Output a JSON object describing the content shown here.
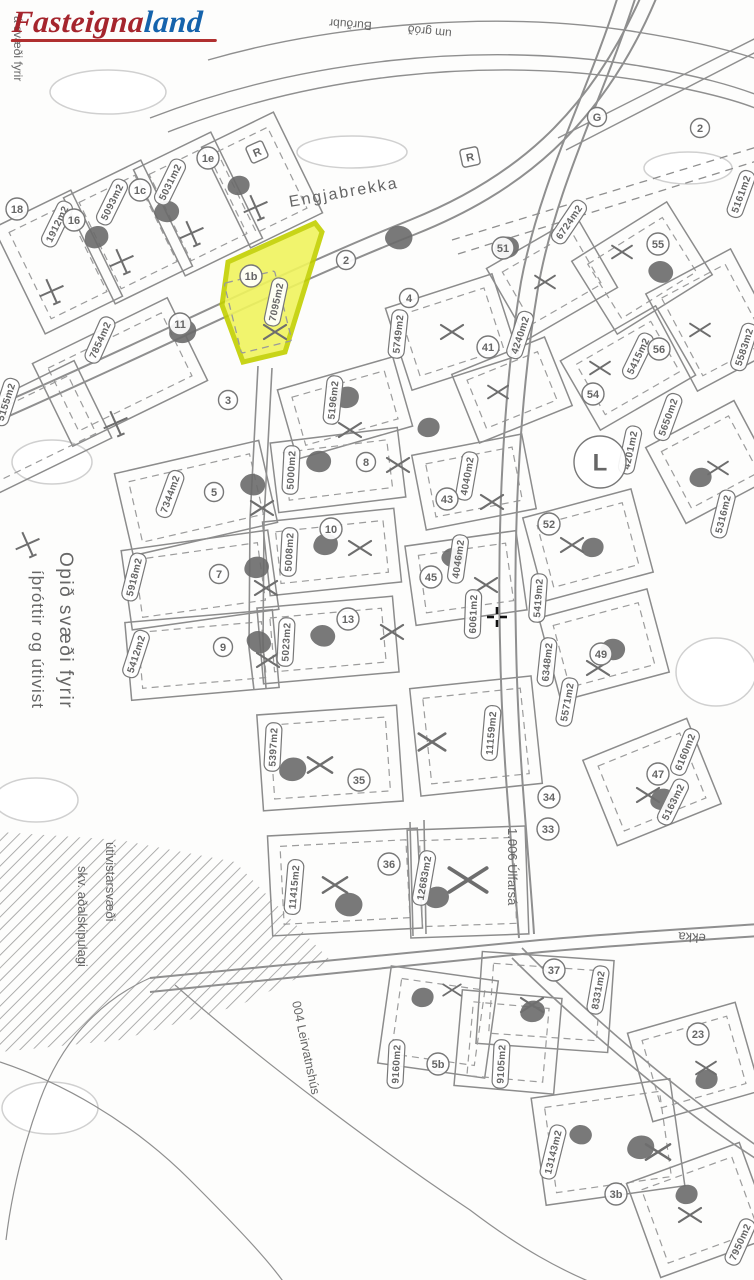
{
  "logo": {
    "text_red": "Fasteigna",
    "text_blue": "land"
  },
  "streets": {
    "engjabrekka": "Engjabrekka",
    "bottom_partial": "ekka",
    "top_partial_a": "Burðubr",
    "top_partial_b": "um gróð"
  },
  "open_area": {
    "line1": "Opið svæði fyrir",
    "line2": "íþróttir og útivist",
    "edge_partial": "á svæði fyrir"
  },
  "hatch_area": {
    "line1": "útivistarsvæði",
    "line2": "skv. aðalskipulagi"
  },
  "annotations": {
    "river": "1.006 Úlfarsá",
    "south": "004 Leirvatnshús"
  },
  "r_station_label": "R",
  "highlight": {
    "number": "1b",
    "area": "7095m2",
    "fill": "#f0f45e",
    "stroke": "#c3d000"
  },
  "big_circle": {
    "t": "L",
    "x": 600,
    "y": 462
  },
  "area_labels": [
    {
      "t": "1912m2",
      "x": 57,
      "y": 224,
      "r": -64
    },
    {
      "t": "5093m2",
      "x": 112,
      "y": 202,
      "r": -64
    },
    {
      "t": "5031m2",
      "x": 170,
      "y": 182,
      "r": -64
    },
    {
      "t": "7854m2",
      "x": 100,
      "y": 340,
      "r": -66
    },
    {
      "t": "5155m2",
      "x": 6,
      "y": 402,
      "r": -72
    },
    {
      "t": "7344m2",
      "x": 170,
      "y": 494,
      "r": -70
    },
    {
      "t": "5918m2",
      "x": 134,
      "y": 577,
      "r": -76
    },
    {
      "t": "5412m2",
      "x": 136,
      "y": 654,
      "r": -72
    },
    {
      "t": "5196m2",
      "x": 333,
      "y": 400,
      "r": -84
    },
    {
      "t": "5000m2",
      "x": 291,
      "y": 470,
      "r": -87
    },
    {
      "t": "5008m2",
      "x": 289,
      "y": 552,
      "r": -87
    },
    {
      "t": "5023m2",
      "x": 286,
      "y": 642,
      "r": -87
    },
    {
      "t": "5397m2",
      "x": 273,
      "y": 747,
      "r": -87
    },
    {
      "t": "11415m2",
      "x": 294,
      "y": 887,
      "r": -85
    },
    {
      "t": "12683m2",
      "x": 424,
      "y": 878,
      "r": -80
    },
    {
      "t": "5749m2",
      "x": 398,
      "y": 334,
      "r": -84
    },
    {
      "t": "4240m2",
      "x": 520,
      "y": 335,
      "r": -72
    },
    {
      "t": "4040m2",
      "x": 467,
      "y": 476,
      "r": -80
    },
    {
      "t": "4046m2",
      "x": 458,
      "y": 559,
      "r": -82
    },
    {
      "t": "6061m2",
      "x": 473,
      "y": 614,
      "r": -88
    },
    {
      "t": "11159m2",
      "x": 491,
      "y": 733,
      "r": -85
    },
    {
      "t": "6724m2",
      "x": 569,
      "y": 222,
      "r": -56
    },
    {
      "t": "5161m2",
      "x": 741,
      "y": 194,
      "r": -70
    },
    {
      "t": "5583m2",
      "x": 744,
      "y": 347,
      "r": -72
    },
    {
      "t": "5415m2",
      "x": 638,
      "y": 356,
      "r": -64
    },
    {
      "t": "4201m2",
      "x": 630,
      "y": 450,
      "r": -78
    },
    {
      "t": "5650m2",
      "x": 668,
      "y": 417,
      "r": -70
    },
    {
      "t": "5419m2",
      "x": 538,
      "y": 598,
      "r": -86
    },
    {
      "t": "6348m2",
      "x": 547,
      "y": 662,
      "r": -84
    },
    {
      "t": "5571m2",
      "x": 567,
      "y": 702,
      "r": -80
    },
    {
      "t": "5316m2",
      "x": 723,
      "y": 514,
      "r": -76
    },
    {
      "t": "6160m2",
      "x": 685,
      "y": 752,
      "r": -68
    },
    {
      "t": "5163m2",
      "x": 673,
      "y": 802,
      "r": -64
    },
    {
      "t": "8331m2",
      "x": 598,
      "y": 990,
      "r": -80
    },
    {
      "t": "9160m2",
      "x": 396,
      "y": 1064,
      "r": -87
    },
    {
      "t": "9105m2",
      "x": 501,
      "y": 1064,
      "r": -87
    },
    {
      "t": "13143m2",
      "x": 553,
      "y": 1152,
      "r": -76
    },
    {
      "t": "7950m2",
      "x": 740,
      "y": 1242,
      "r": -66
    }
  ],
  "plot_numbers": [
    {
      "t": "18",
      "x": 17,
      "y": 209
    },
    {
      "t": "16",
      "x": 74,
      "y": 220
    },
    {
      "t": "1c",
      "x": 140,
      "y": 190
    },
    {
      "t": "1e",
      "x": 208,
      "y": 158
    },
    {
      "t": "G",
      "x": 597,
      "y": 117
    },
    {
      "t": "2",
      "x": 700,
      "y": 128
    },
    {
      "t": "11",
      "x": 180,
      "y": 324
    },
    {
      "t": "2",
      "x": 346,
      "y": 260
    },
    {
      "t": "3",
      "x": 228,
      "y": 400
    },
    {
      "t": "5",
      "x": 214,
      "y": 492
    },
    {
      "t": "7",
      "x": 219,
      "y": 574
    },
    {
      "t": "9",
      "x": 223,
      "y": 647
    },
    {
      "t": "8",
      "x": 366,
      "y": 462
    },
    {
      "t": "10",
      "x": 331,
      "y": 529
    },
    {
      "t": "13",
      "x": 348,
      "y": 619
    },
    {
      "t": "4",
      "x": 409,
      "y": 298
    },
    {
      "t": "41",
      "x": 488,
      "y": 347
    },
    {
      "t": "43",
      "x": 447,
      "y": 499
    },
    {
      "t": "45",
      "x": 431,
      "y": 577
    },
    {
      "t": "35",
      "x": 359,
      "y": 780
    },
    {
      "t": "36",
      "x": 389,
      "y": 864
    },
    {
      "t": "34",
      "x": 549,
      "y": 797
    },
    {
      "t": "33",
      "x": 548,
      "y": 829
    },
    {
      "t": "51",
      "x": 503,
      "y": 248
    },
    {
      "t": "55",
      "x": 658,
      "y": 244
    },
    {
      "t": "56",
      "x": 659,
      "y": 349
    },
    {
      "t": "54",
      "x": 593,
      "y": 394
    },
    {
      "t": "52",
      "x": 549,
      "y": 524
    },
    {
      "t": "49",
      "x": 601,
      "y": 654
    },
    {
      "t": "47",
      "x": 658,
      "y": 774
    },
    {
      "t": "37",
      "x": 554,
      "y": 970
    },
    {
      "t": "5b",
      "x": 438,
      "y": 1064
    },
    {
      "t": "23",
      "x": 698,
      "y": 1034
    },
    {
      "t": "3b",
      "x": 616,
      "y": 1194
    }
  ],
  "cursor": {
    "type": "crosshair",
    "x": 497,
    "y": 617
  }
}
